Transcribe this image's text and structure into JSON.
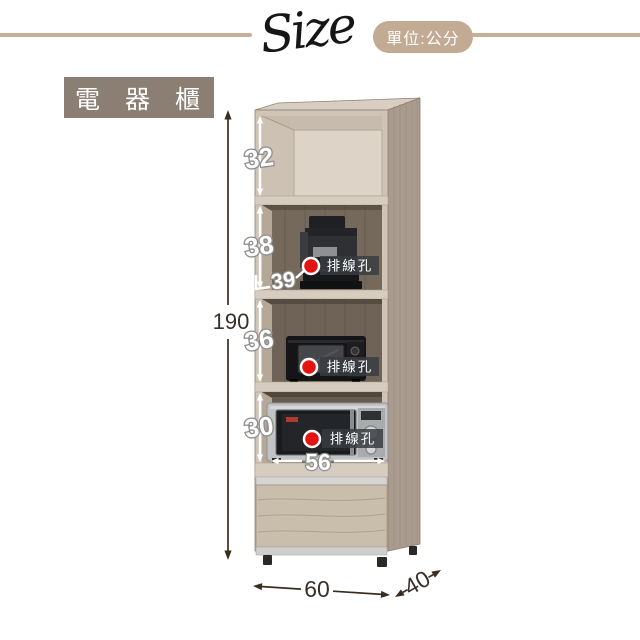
{
  "header": {
    "script_text": "Size",
    "unit_label": "單位:公分"
  },
  "title": {
    "text": "電 器 櫃"
  },
  "dims": {
    "total_height": "190",
    "door_height": "32",
    "shelf1_height": "38",
    "shelf1_front": "39",
    "shelf2_height": "36",
    "shelf3_height": "30",
    "inner_width": "56",
    "width": "60",
    "depth": "40"
  },
  "labels": {
    "cable_hole": "排線孔"
  },
  "colors": {
    "accent_tan": "#c3aa93",
    "title_bg": "#8b7e72",
    "dot_red": "#e41310",
    "badge_bg": "#383c40",
    "wood_side": "#a99b8d",
    "wood_front": "#cfc4b6",
    "door_panel": "#ddd3c6",
    "interior_back": "#75695c",
    "drawer_front": "#c9bdac"
  }
}
